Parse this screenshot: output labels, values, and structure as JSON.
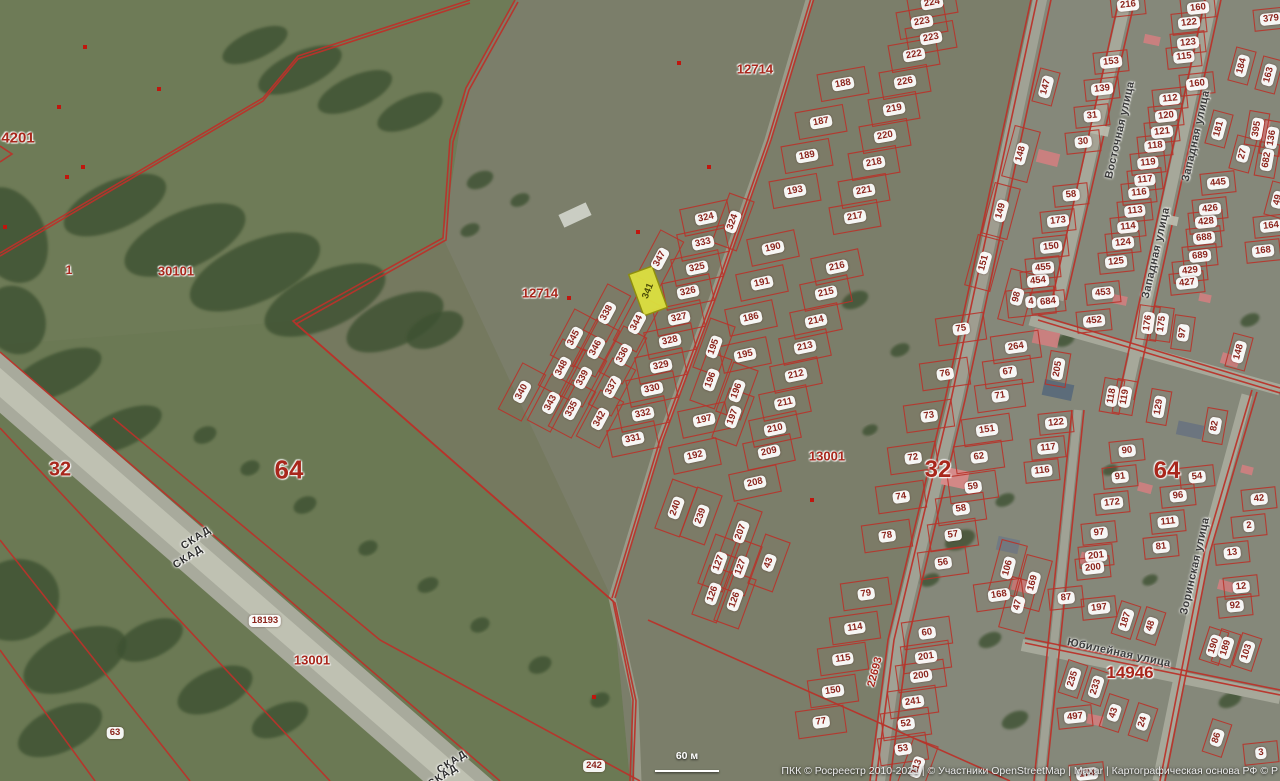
{
  "attribution": {
    "text": "ПКК © Росреестр 2010-2021 | © Участники OpenStreetMap | Maxar | Картографическая основа РФ © Р"
  },
  "scale_bar": {
    "label": "60 м"
  },
  "selected_parcel": {
    "label": "341",
    "x": 648,
    "y": 291,
    "w": 25,
    "h": 44,
    "rot": -20,
    "label_rot": -68,
    "fill": "#dce03f",
    "stroke": "#90900a"
  },
  "colors": {
    "parcel_line": "#b9332a",
    "pill_text": "#8b241c",
    "zone_text": "#a8271c",
    "street_text": "#3c3c3c",
    "selected_fill": "#dce03f"
  },
  "streets": [
    {
      "text": "Восточная улица",
      "x": 1120,
      "y": 130,
      "rot": -77
    },
    {
      "text": "Западная улица",
      "x": 1196,
      "y": 136,
      "rot": -77
    },
    {
      "text": "Западная улица",
      "x": 1156,
      "y": 253,
      "rot": -77
    },
    {
      "text": "Зоринская улица",
      "x": 1195,
      "y": 566,
      "rot": -77
    },
    {
      "text": "Юбилейная улица",
      "x": 1119,
      "y": 653,
      "rot": 12
    }
  ],
  "zones": [
    {
      "text": "4201",
      "x": 18,
      "y": 138,
      "size": 15
    },
    {
      "text": "1",
      "x": 69,
      "y": 270,
      "size": 12
    },
    {
      "text": "30101",
      "x": 176,
      "y": 271,
      "size": 13
    },
    {
      "text": "12714",
      "x": 755,
      "y": 69,
      "size": 13
    },
    {
      "text": "12714",
      "x": 540,
      "y": 293,
      "size": 13
    },
    {
      "text": "32",
      "x": 60,
      "y": 470,
      "size": 20
    },
    {
      "text": "64",
      "x": 289,
      "y": 470,
      "size": 26
    },
    {
      "text": "32",
      "x": 938,
      "y": 470,
      "size": 24
    },
    {
      "text": "64",
      "x": 1167,
      "y": 471,
      "size": 24
    },
    {
      "text": "13001",
      "x": 827,
      "y": 456,
      "size": 13
    },
    {
      "text": "13001",
      "x": 312,
      "y": 660,
      "size": 13
    },
    {
      "text": "22693",
      "x": 875,
      "y": 672,
      "size": 11,
      "rot": -75
    },
    {
      "text": "14946",
      "x": 1130,
      "y": 673,
      "size": 17
    }
  ],
  "road_labels": [
    {
      "text": "СКАД",
      "x": 196,
      "y": 538,
      "rot": -33
    },
    {
      "text": "СКАД",
      "x": 188,
      "y": 557,
      "rot": -33
    },
    {
      "text": "СКАД",
      "x": 452,
      "y": 762,
      "rot": -33
    },
    {
      "text": "СКАД",
      "x": 443,
      "y": 776,
      "rot": -33
    }
  ],
  "parcels": [
    {
      "t": "224",
      "x": 932,
      "y": 3,
      "r": -10
    },
    {
      "t": "223",
      "x": 922,
      "y": 22,
      "r": -10
    },
    {
      "t": "223",
      "x": 931,
      "y": 38,
      "r": -10
    },
    {
      "t": "222",
      "x": 914,
      "y": 55,
      "r": -10
    },
    {
      "t": "226",
      "x": 905,
      "y": 82,
      "r": -10
    },
    {
      "t": "219",
      "x": 894,
      "y": 109,
      "r": -10
    },
    {
      "t": "220",
      "x": 885,
      "y": 136,
      "r": -10
    },
    {
      "t": "218",
      "x": 874,
      "y": 163,
      "r": -10
    },
    {
      "t": "221",
      "x": 864,
      "y": 191,
      "r": -10
    },
    {
      "t": "217",
      "x": 855,
      "y": 217,
      "r": -10
    },
    {
      "t": "188",
      "x": 843,
      "y": 84,
      "r": -10
    },
    {
      "t": "187",
      "x": 821,
      "y": 122,
      "r": -10
    },
    {
      "t": "189",
      "x": 807,
      "y": 156,
      "r": -10
    },
    {
      "t": "193",
      "x": 795,
      "y": 191,
      "r": -10
    },
    {
      "t": "147",
      "x": 1046,
      "y": 87,
      "r": -75
    },
    {
      "t": "148",
      "x": 1021,
      "y": 154,
      "r": -75
    },
    {
      "t": "149",
      "x": 1001,
      "y": 211,
      "r": -75
    },
    {
      "t": "324",
      "x": 706,
      "y": 218,
      "r": -12
    },
    {
      "t": "324",
      "x": 733,
      "y": 222,
      "r": -70
    },
    {
      "t": "333",
      "x": 703,
      "y": 243,
      "r": -12
    },
    {
      "t": "347",
      "x": 660,
      "y": 259,
      "r": -62
    },
    {
      "t": "325",
      "x": 697,
      "y": 268,
      "r": -12
    },
    {
      "t": "326",
      "x": 688,
      "y": 292,
      "r": -12
    },
    {
      "t": "327",
      "x": 679,
      "y": 318,
      "r": -12
    },
    {
      "t": "328",
      "x": 670,
      "y": 341,
      "r": -12
    },
    {
      "t": "329",
      "x": 661,
      "y": 366,
      "r": -12
    },
    {
      "t": "330",
      "x": 652,
      "y": 389,
      "r": -12
    },
    {
      "t": "332",
      "x": 643,
      "y": 414,
      "r": -12
    },
    {
      "t": "331",
      "x": 633,
      "y": 439,
      "r": -12
    },
    {
      "t": "338",
      "x": 607,
      "y": 313,
      "r": -62
    },
    {
      "t": "344",
      "x": 637,
      "y": 323,
      "r": -62
    },
    {
      "t": "345",
      "x": 574,
      "y": 338,
      "r": -62
    },
    {
      "t": "346",
      "x": 596,
      "y": 348,
      "r": -62
    },
    {
      "t": "336",
      "x": 623,
      "y": 355,
      "r": -62
    },
    {
      "t": "348",
      "x": 562,
      "y": 368,
      "r": -62
    },
    {
      "t": "339",
      "x": 583,
      "y": 378,
      "r": -62
    },
    {
      "t": "337",
      "x": 612,
      "y": 387,
      "r": -62
    },
    {
      "t": "340",
      "x": 522,
      "y": 392,
      "r": -62
    },
    {
      "t": "343",
      "x": 551,
      "y": 403,
      "r": -62
    },
    {
      "t": "335",
      "x": 572,
      "y": 409,
      "r": -62
    },
    {
      "t": "342",
      "x": 600,
      "y": 419,
      "r": -62
    },
    {
      "t": "190",
      "x": 773,
      "y": 248,
      "r": -12
    },
    {
      "t": "191",
      "x": 762,
      "y": 283,
      "r": -12
    },
    {
      "t": "186",
      "x": 751,
      "y": 318,
      "r": -12
    },
    {
      "t": "195",
      "x": 714,
      "y": 347,
      "r": -70
    },
    {
      "t": "195",
      "x": 745,
      "y": 355,
      "r": -12
    },
    {
      "t": "196",
      "x": 711,
      "y": 380,
      "r": -70
    },
    {
      "t": "196",
      "x": 737,
      "y": 391,
      "r": -70
    },
    {
      "t": "197",
      "x": 704,
      "y": 420,
      "r": -12
    },
    {
      "t": "197",
      "x": 733,
      "y": 417,
      "r": -70
    },
    {
      "t": "216",
      "x": 837,
      "y": 267,
      "r": -12
    },
    {
      "t": "215",
      "x": 826,
      "y": 293,
      "r": -12
    },
    {
      "t": "214",
      "x": 816,
      "y": 321,
      "r": -12
    },
    {
      "t": "213",
      "x": 805,
      "y": 347,
      "r": -12
    },
    {
      "t": "212",
      "x": 796,
      "y": 375,
      "r": -12
    },
    {
      "t": "211",
      "x": 785,
      "y": 403,
      "r": -12
    },
    {
      "t": "210",
      "x": 775,
      "y": 429,
      "r": -12
    },
    {
      "t": "209",
      "x": 769,
      "y": 452,
      "r": -12
    },
    {
      "t": "208",
      "x": 755,
      "y": 483,
      "r": -12
    },
    {
      "t": "192",
      "x": 695,
      "y": 456,
      "r": -12
    },
    {
      "t": "240",
      "x": 676,
      "y": 508,
      "r": -70
    },
    {
      "t": "239",
      "x": 701,
      "y": 516,
      "r": -70
    },
    {
      "t": "207",
      "x": 741,
      "y": 532,
      "r": -70
    },
    {
      "t": "127",
      "x": 719,
      "y": 563,
      "r": -70
    },
    {
      "t": "127",
      "x": 741,
      "y": 567,
      "r": -70
    },
    {
      "t": "43",
      "x": 769,
      "y": 563,
      "r": -70
    },
    {
      "t": "126",
      "x": 713,
      "y": 594,
      "r": -70
    },
    {
      "t": "126",
      "x": 735,
      "y": 600,
      "r": -70
    },
    {
      "t": "151",
      "x": 984,
      "y": 263,
      "r": -75
    },
    {
      "t": "75",
      "x": 961,
      "y": 329,
      "r": -8
    },
    {
      "t": "264",
      "x": 1016,
      "y": 347,
      "r": -8
    },
    {
      "t": "76",
      "x": 945,
      "y": 374,
      "r": -8
    },
    {
      "t": "67",
      "x": 1008,
      "y": 372,
      "r": -8
    },
    {
      "t": "71",
      "x": 1000,
      "y": 396,
      "r": -8
    },
    {
      "t": "73",
      "x": 929,
      "y": 416,
      "r": -8
    },
    {
      "t": "151",
      "x": 987,
      "y": 430,
      "r": -8
    },
    {
      "t": "72",
      "x": 913,
      "y": 458,
      "r": -8
    },
    {
      "t": "62",
      "x": 979,
      "y": 457,
      "r": -8
    },
    {
      "t": "59",
      "x": 973,
      "y": 487,
      "r": -8
    },
    {
      "t": "74",
      "x": 901,
      "y": 497,
      "r": -8
    },
    {
      "t": "58",
      "x": 961,
      "y": 509,
      "r": -8
    },
    {
      "t": "78",
      "x": 887,
      "y": 536,
      "r": -8
    },
    {
      "t": "57",
      "x": 953,
      "y": 535,
      "r": -8
    },
    {
      "t": "56",
      "x": 943,
      "y": 563,
      "r": -8
    },
    {
      "t": "79",
      "x": 866,
      "y": 594,
      "r": -8
    },
    {
      "t": "60",
      "x": 927,
      "y": 633,
      "r": -8
    },
    {
      "t": "114",
      "x": 855,
      "y": 628,
      "r": -8
    },
    {
      "t": "201",
      "x": 926,
      "y": 657,
      "r": -8
    },
    {
      "t": "115",
      "x": 843,
      "y": 659,
      "r": -8
    },
    {
      "t": "200",
      "x": 921,
      "y": 676,
      "r": -8
    },
    {
      "t": "150",
      "x": 833,
      "y": 691,
      "r": -8
    },
    {
      "t": "241",
      "x": 913,
      "y": 702,
      "r": -8
    },
    {
      "t": "52",
      "x": 906,
      "y": 724,
      "r": -8
    },
    {
      "t": "53",
      "x": 903,
      "y": 749,
      "r": -8
    },
    {
      "t": "77",
      "x": 821,
      "y": 722,
      "r": -8
    },
    {
      "t": "113",
      "x": 917,
      "y": 767,
      "r": -70
    },
    {
      "t": "106",
      "x": 1008,
      "y": 568,
      "r": -75
    },
    {
      "t": "168",
      "x": 999,
      "y": 595,
      "r": -8
    },
    {
      "t": "47",
      "x": 1018,
      "y": 605,
      "r": -75
    },
    {
      "t": "169",
      "x": 1033,
      "y": 583,
      "r": -75
    },
    {
      "t": "216",
      "x": 1128,
      "y": 5,
      "r": -6
    },
    {
      "t": "160",
      "x": 1198,
      "y": 8,
      "r": -6
    },
    {
      "t": "122",
      "x": 1189,
      "y": 23,
      "r": -6
    },
    {
      "t": "379",
      "x": 1271,
      "y": 19,
      "r": -6
    },
    {
      "t": "123",
      "x": 1188,
      "y": 43,
      "r": -6
    },
    {
      "t": "115",
      "x": 1184,
      "y": 57,
      "r": -6
    },
    {
      "t": "153",
      "x": 1111,
      "y": 62,
      "r": -6
    },
    {
      "t": "139",
      "x": 1102,
      "y": 89,
      "r": -6
    },
    {
      "t": "184",
      "x": 1242,
      "y": 66,
      "r": -75
    },
    {
      "t": "163",
      "x": 1269,
      "y": 75,
      "r": -75
    },
    {
      "t": "31",
      "x": 1092,
      "y": 116,
      "r": -6
    },
    {
      "t": "160",
      "x": 1197,
      "y": 84,
      "r": -6
    },
    {
      "t": "112",
      "x": 1170,
      "y": 99,
      "r": -6
    },
    {
      "t": "30",
      "x": 1083,
      "y": 142,
      "r": -6
    },
    {
      "t": "120",
      "x": 1166,
      "y": 116,
      "r": -6
    },
    {
      "t": "121",
      "x": 1162,
      "y": 132,
      "r": -6
    },
    {
      "t": "118",
      "x": 1155,
      "y": 146,
      "r": -6
    },
    {
      "t": "119",
      "x": 1148,
      "y": 163,
      "r": -6
    },
    {
      "t": "58",
      "x": 1071,
      "y": 195,
      "r": -6
    },
    {
      "t": "117",
      "x": 1145,
      "y": 180,
      "r": -6
    },
    {
      "t": "116",
      "x": 1139,
      "y": 193,
      "r": -6
    },
    {
      "t": "181",
      "x": 1219,
      "y": 129,
      "r": -75
    },
    {
      "t": "27",
      "x": 1243,
      "y": 154,
      "r": -75
    },
    {
      "t": "395",
      "x": 1257,
      "y": 129,
      "r": -80
    },
    {
      "t": "136",
      "x": 1272,
      "y": 138,
      "r": -80
    },
    {
      "t": "682",
      "x": 1267,
      "y": 160,
      "r": -80
    },
    {
      "t": "49",
      "x": 1278,
      "y": 200,
      "r": -75
    },
    {
      "t": "173",
      "x": 1058,
      "y": 221,
      "r": -6
    },
    {
      "t": "113",
      "x": 1135,
      "y": 211,
      "r": -6
    },
    {
      "t": "150",
      "x": 1051,
      "y": 247,
      "r": -6
    },
    {
      "t": "114",
      "x": 1128,
      "y": 227,
      "r": -6
    },
    {
      "t": "445",
      "x": 1218,
      "y": 183,
      "r": -6
    },
    {
      "t": "124",
      "x": 1123,
      "y": 243,
      "r": -6
    },
    {
      "t": "164",
      "x": 1271,
      "y": 226,
      "r": -6
    },
    {
      "t": "426",
      "x": 1210,
      "y": 209,
      "r": -6
    },
    {
      "t": "428",
      "x": 1206,
      "y": 222,
      "r": -6
    },
    {
      "t": "168",
      "x": 1263,
      "y": 251,
      "r": -6
    },
    {
      "t": "688",
      "x": 1204,
      "y": 238,
      "r": -6
    },
    {
      "t": "689",
      "x": 1200,
      "y": 256,
      "r": -6
    },
    {
      "t": "125",
      "x": 1116,
      "y": 262,
      "r": -6
    },
    {
      "t": "429",
      "x": 1190,
      "y": 271,
      "r": -6
    },
    {
      "t": "427",
      "x": 1187,
      "y": 283,
      "r": -6
    },
    {
      "t": "455",
      "x": 1043,
      "y": 268,
      "r": -6
    },
    {
      "t": "454",
      "x": 1038,
      "y": 281,
      "r": -6
    },
    {
      "t": "4",
      "x": 1031,
      "y": 302,
      "r": -6
    },
    {
      "t": "684",
      "x": 1048,
      "y": 302,
      "r": -6
    },
    {
      "t": "98",
      "x": 1017,
      "y": 297,
      "r": -75
    },
    {
      "t": "453",
      "x": 1103,
      "y": 293,
      "r": -6
    },
    {
      "t": "452",
      "x": 1094,
      "y": 321,
      "r": -6
    },
    {
      "t": "176",
      "x": 1148,
      "y": 323,
      "r": -82
    },
    {
      "t": "175",
      "x": 1162,
      "y": 324,
      "r": -82
    },
    {
      "t": "97",
      "x": 1183,
      "y": 333,
      "r": -82
    },
    {
      "t": "148",
      "x": 1239,
      "y": 352,
      "r": -75
    },
    {
      "t": "205",
      "x": 1058,
      "y": 369,
      "r": -80
    },
    {
      "t": "118",
      "x": 1112,
      "y": 396,
      "r": -80
    },
    {
      "t": "119",
      "x": 1125,
      "y": 397,
      "r": -80
    },
    {
      "t": "129",
      "x": 1159,
      "y": 407,
      "r": -80
    },
    {
      "t": "122",
      "x": 1056,
      "y": 423,
      "r": -6
    },
    {
      "t": "82",
      "x": 1215,
      "y": 426,
      "r": -80
    },
    {
      "t": "117",
      "x": 1048,
      "y": 448,
      "r": -6
    },
    {
      "t": "90",
      "x": 1127,
      "y": 451,
      "r": -6
    },
    {
      "t": "116",
      "x": 1042,
      "y": 471,
      "r": -6
    },
    {
      "t": "54",
      "x": 1197,
      "y": 477,
      "r": -6
    },
    {
      "t": "91",
      "x": 1120,
      "y": 477,
      "r": -6
    },
    {
      "t": "96",
      "x": 1178,
      "y": 496,
      "r": -6
    },
    {
      "t": "42",
      "x": 1259,
      "y": 499,
      "r": -6
    },
    {
      "t": "172",
      "x": 1112,
      "y": 503,
      "r": -6
    },
    {
      "t": "111",
      "x": 1168,
      "y": 522,
      "r": -6
    },
    {
      "t": "2",
      "x": 1249,
      "y": 526,
      "r": -6
    },
    {
      "t": "97",
      "x": 1099,
      "y": 533,
      "r": -6
    },
    {
      "t": "81",
      "x": 1161,
      "y": 547,
      "r": -6
    },
    {
      "t": "13",
      "x": 1232,
      "y": 553,
      "r": -6
    },
    {
      "t": "201",
      "x": 1096,
      "y": 556,
      "r": -6
    },
    {
      "t": "200",
      "x": 1093,
      "y": 568,
      "r": -6
    },
    {
      "t": "12",
      "x": 1241,
      "y": 587,
      "r": -6
    },
    {
      "t": "87",
      "x": 1066,
      "y": 598,
      "r": -6
    },
    {
      "t": "92",
      "x": 1235,
      "y": 606,
      "r": -6
    },
    {
      "t": "197",
      "x": 1099,
      "y": 608,
      "r": -6
    },
    {
      "t": "187",
      "x": 1126,
      "y": 620,
      "r": -72
    },
    {
      "t": "48",
      "x": 1151,
      "y": 626,
      "r": -72
    },
    {
      "t": "190",
      "x": 1214,
      "y": 646,
      "r": -72
    },
    {
      "t": "189",
      "x": 1226,
      "y": 648,
      "r": -72
    },
    {
      "t": "103",
      "x": 1247,
      "y": 652,
      "r": -72
    },
    {
      "t": "235",
      "x": 1073,
      "y": 679,
      "r": -72
    },
    {
      "t": "233",
      "x": 1096,
      "y": 687,
      "r": -72
    },
    {
      "t": "497",
      "x": 1075,
      "y": 717,
      "r": -6
    },
    {
      "t": "43",
      "x": 1114,
      "y": 713,
      "r": -72
    },
    {
      "t": "24",
      "x": 1143,
      "y": 722,
      "r": -72
    },
    {
      "t": "86",
      "x": 1217,
      "y": 738,
      "r": -72
    },
    {
      "t": "3",
      "x": 1261,
      "y": 753,
      "r": -6
    },
    {
      "t": "174",
      "x": 1087,
      "y": 774,
      "r": -6
    },
    {
      "t": "18193",
      "x": 265,
      "y": 621,
      "r": 0,
      "nr": 1
    },
    {
      "t": "63",
      "x": 115,
      "y": 733,
      "r": 0,
      "nr": 1
    },
    {
      "t": "242",
      "x": 594,
      "y": 766,
      "r": 0,
      "nr": 1
    }
  ],
  "dots": [
    [
      85,
      47
    ],
    [
      59,
      107
    ],
    [
      83,
      167
    ],
    [
      67,
      177
    ],
    [
      5,
      227
    ],
    [
      159,
      89
    ],
    [
      679,
      63
    ],
    [
      709,
      167
    ],
    [
      638,
      232
    ],
    [
      569,
      298
    ],
    [
      594,
      697
    ],
    [
      812,
      500
    ]
  ]
}
